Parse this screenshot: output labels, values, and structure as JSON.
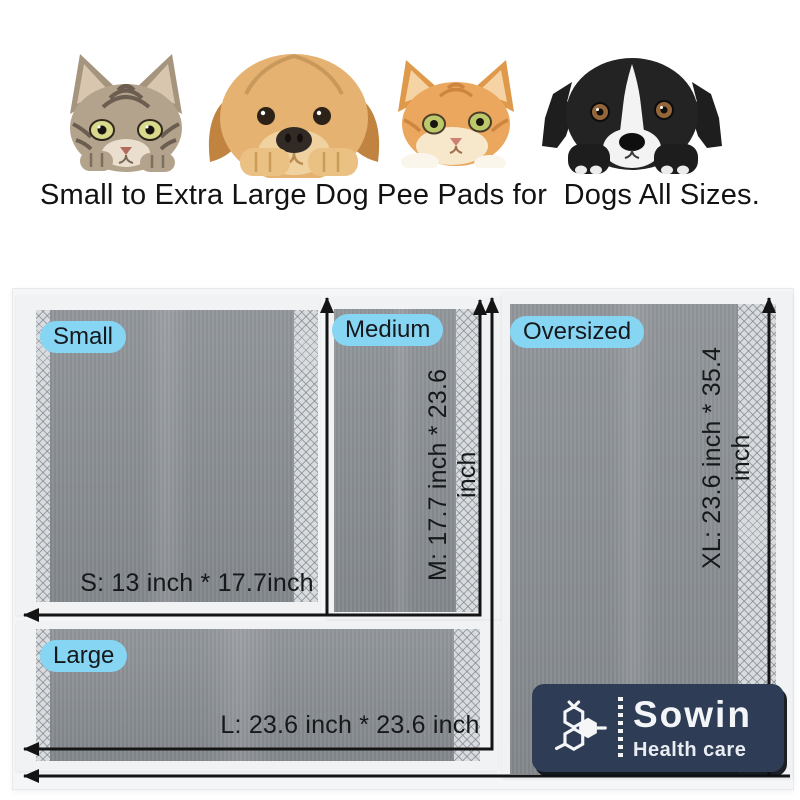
{
  "header": {
    "headline": "Small to Extra Large Dog Pee Pads for  Dogs All Sizes.",
    "animals": [
      {
        "icon": "tabby-cat-icon"
      },
      {
        "icon": "golden-retriever-icon"
      },
      {
        "icon": "orange-cat-icon"
      },
      {
        "icon": "border-collie-icon"
      }
    ]
  },
  "diagram": {
    "label_pill_color": "#85d5f3",
    "arrow_color": "#141414",
    "pads": [
      {
        "label": "Small",
        "dimension": "S: 13 inch * 17.7inch"
      },
      {
        "label": "Medium",
        "dimension": "M: 17.7 inch * 23.6 inch"
      },
      {
        "label": "Oversized",
        "dimension": "XL: 23.6 inch * 35.4 inch"
      },
      {
        "label": "Large",
        "dimension": "L: 23.6 inch * 23.6 inch"
      }
    ]
  },
  "logo": {
    "brand": "Sowin",
    "tagline": "Health care",
    "bg_color": "#2e3d55",
    "icon": "hexagon-molecule-icon"
  }
}
